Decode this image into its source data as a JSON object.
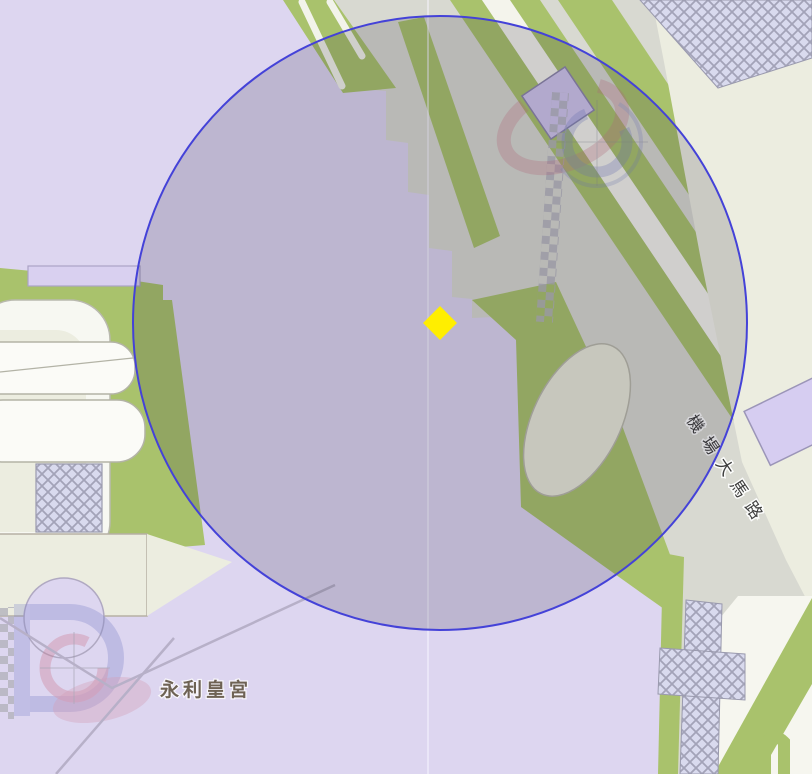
{
  "map": {
    "kind": "street-map",
    "labels": {
      "place_label": "永利皇宮",
      "road_label": "機場大馬路"
    },
    "marker": {
      "shape": "diamond",
      "color": "#ffee00",
      "x": 440,
      "y": 323
    },
    "overlay_circle": {
      "cx": 440,
      "cy": 323,
      "r": 307,
      "stroke_color": "#4442d8",
      "fill_color": "rgba(30,25,48,0.165)"
    },
    "colors": {
      "land_lavender": "#ddd6f0",
      "land_cream": "#ecede0",
      "road_surface_gray": "#d8d9d1",
      "road_white": "#f7f8f1",
      "grass_green": "#a9c26c",
      "construction_hatch_bg": "#d9daee",
      "construction_hatch_line": "#a3a3b8",
      "place_label_text": "#6e6254",
      "road_label_text": "#3e3e3e"
    },
    "features": {
      "attraction_icon_top_right": "faded red-blue attraction swirl",
      "attraction_icon_bottom_left": "faded red-blue attraction swirl",
      "construction_areas": "cross-hatched polygons",
      "crosswalk_checker_strips": "gray checker strips"
    }
  }
}
